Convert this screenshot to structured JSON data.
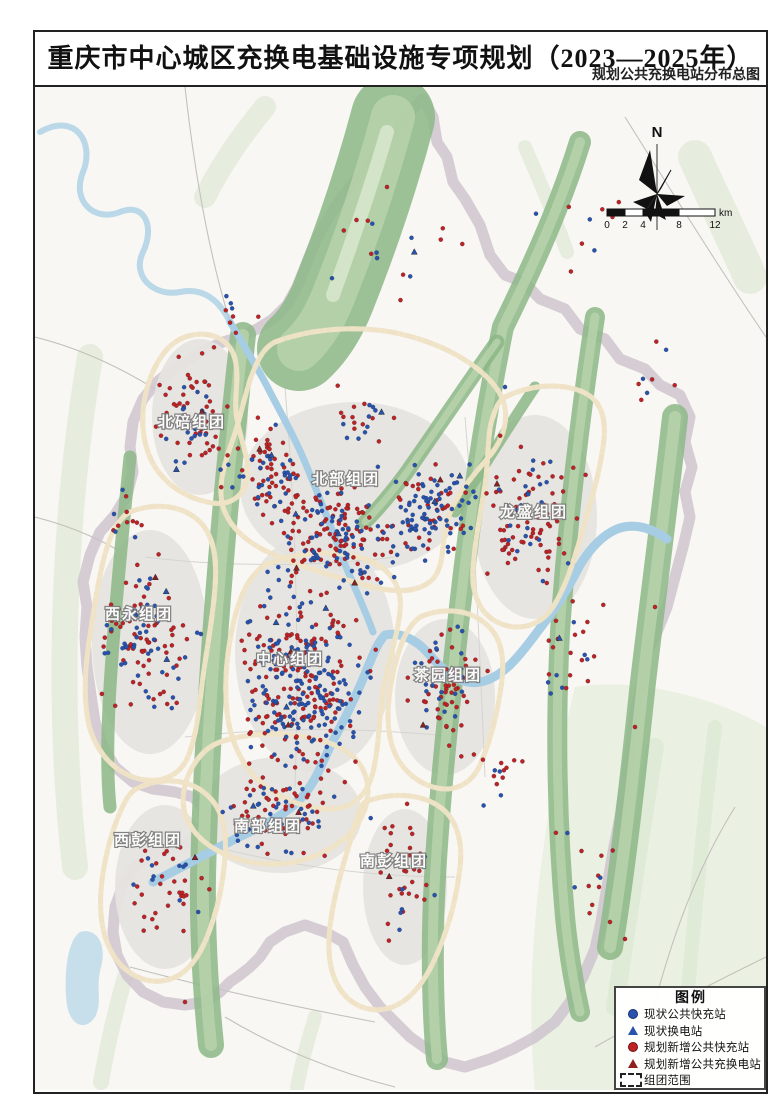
{
  "page": {
    "title": "重庆市中心城区充换电基础设施专项规划（2023—2025年）",
    "subtitle": "规划公共充换电站分布总图"
  },
  "map": {
    "north_label": "N",
    "scalebar": {
      "ticks": [
        "0",
        "2",
        "4",
        "8",
        "12"
      ],
      "unit": "km"
    },
    "legend": {
      "title": "图例",
      "items": [
        {
          "symbol": "sym-dot-blue",
          "name": "existing-fast-charge-station",
          "label": "现状公共快充站"
        },
        {
          "symbol": "sym-tri-blue",
          "name": "existing-swap-station",
          "label": "现状换电站"
        },
        {
          "symbol": "sym-dot-red",
          "name": "planned-fast-charge-station",
          "label": "规划新增公共快充站"
        },
        {
          "symbol": "sym-tri-darkred",
          "name": "planned-charge-swap-station",
          "label": "规划新增公共充换电站"
        },
        {
          "symbol": "sym-dash-box",
          "name": "cluster-boundary",
          "label": "组团范围"
        }
      ]
    },
    "districts": [
      {
        "name": "北碚组团",
        "x": 157,
        "y": 340
      },
      {
        "name": "北部组团",
        "x": 311,
        "y": 397
      },
      {
        "name": "龙盛组团",
        "x": 499,
        "y": 430
      },
      {
        "name": "西永组团",
        "x": 104,
        "y": 532
      },
      {
        "name": "中心组团",
        "x": 255,
        "y": 577
      },
      {
        "name": "茶园组团",
        "x": 413,
        "y": 593
      },
      {
        "name": "西彭组团",
        "x": 113,
        "y": 758
      },
      {
        "name": "南部组团",
        "x": 233,
        "y": 744
      },
      {
        "name": "南彭组团",
        "x": 359,
        "y": 779
      }
    ],
    "colors": {
      "red": "#bf2222",
      "blue": "#2753ae",
      "tri_red": "#8e2020",
      "boundary": "#a293a2",
      "ridge": "#8cb786",
      "river": "#a6cde4"
    },
    "station_clusters": [
      {
        "cx": 270,
        "cy": 590,
        "rx": 82,
        "ry": 115,
        "red": 150,
        "blue": 165,
        "tri_red": 3,
        "tri_blue": 3
      },
      {
        "cx": 300,
        "cy": 445,
        "rx": 95,
        "ry": 75,
        "red": 115,
        "blue": 75,
        "tri_red": 2,
        "tri_blue": 2
      },
      {
        "cx": 395,
        "cy": 420,
        "rx": 60,
        "ry": 65,
        "red": 35,
        "blue": 75,
        "tri_red": 1,
        "tri_blue": 2
      },
      {
        "cx": 235,
        "cy": 385,
        "rx": 55,
        "ry": 60,
        "red": 50,
        "blue": 28,
        "tri_red": 1,
        "tri_blue": 1
      },
      {
        "cx": 160,
        "cy": 330,
        "rx": 48,
        "ry": 75,
        "red": 48,
        "blue": 20,
        "tri_red": 1,
        "tri_blue": 1
      },
      {
        "cx": 110,
        "cy": 555,
        "rx": 62,
        "ry": 115,
        "red": 65,
        "blue": 48,
        "tri_red": 1,
        "tri_blue": 2
      },
      {
        "cx": 495,
        "cy": 420,
        "rx": 62,
        "ry": 95,
        "red": 80,
        "blue": 22,
        "tri_red": 1,
        "tri_blue": 1
      },
      {
        "cx": 412,
        "cy": 600,
        "rx": 52,
        "ry": 80,
        "red": 55,
        "blue": 22,
        "tri_red": 1,
        "tri_blue": 1
      },
      {
        "cx": 245,
        "cy": 720,
        "rx": 80,
        "ry": 62,
        "red": 60,
        "blue": 32,
        "tri_red": 1,
        "tri_blue": 1
      },
      {
        "cx": 370,
        "cy": 790,
        "rx": 48,
        "ry": 85,
        "red": 32,
        "blue": 8,
        "tri_red": 1,
        "tri_blue": 0
      },
      {
        "cx": 132,
        "cy": 795,
        "rx": 52,
        "ry": 85,
        "red": 32,
        "blue": 10,
        "tri_red": 1,
        "tri_blue": 0
      },
      {
        "cx": 540,
        "cy": 560,
        "rx": 42,
        "ry": 65,
        "red": 16,
        "blue": 7,
        "tri_red": 0,
        "tri_blue": 1
      },
      {
        "cx": 360,
        "cy": 150,
        "rx": 110,
        "ry": 85,
        "red": 9,
        "blue": 6,
        "tri_red": 0,
        "tri_blue": 1
      },
      {
        "cx": 560,
        "cy": 140,
        "rx": 80,
        "ry": 60,
        "red": 7,
        "blue": 4,
        "tri_red": 0,
        "tri_blue": 0
      },
      {
        "cx": 545,
        "cy": 775,
        "rx": 55,
        "ry": 75,
        "red": 9,
        "blue": 3,
        "tri_red": 0,
        "tri_blue": 0
      },
      {
        "cx": 610,
        "cy": 300,
        "rx": 40,
        "ry": 60,
        "red": 5,
        "blue": 3,
        "tri_red": 0,
        "tri_blue": 0
      },
      {
        "cx": 200,
        "cy": 230,
        "rx": 40,
        "ry": 40,
        "red": 6,
        "blue": 3,
        "tri_red": 0,
        "tri_blue": 0
      },
      {
        "cx": 460,
        "cy": 690,
        "rx": 35,
        "ry": 45,
        "red": 10,
        "blue": 4,
        "tri_red": 0,
        "tri_blue": 0
      },
      {
        "cx": 320,
        "cy": 330,
        "rx": 50,
        "ry": 40,
        "red": 12,
        "blue": 8,
        "tri_red": 0,
        "tri_blue": 1
      },
      {
        "cx": 90,
        "cy": 430,
        "rx": 35,
        "ry": 45,
        "red": 8,
        "blue": 4,
        "tri_red": 0,
        "tri_blue": 0
      }
    ],
    "station_singles": [
      {
        "x": 575,
        "y": 835,
        "t": "red"
      },
      {
        "x": 590,
        "y": 852,
        "t": "red"
      },
      {
        "x": 470,
        "y": 300,
        "t": "blue"
      },
      {
        "x": 352,
        "y": 100,
        "t": "red"
      },
      {
        "x": 338,
        "y": 320,
        "t": "blue"
      },
      {
        "x": 620,
        "y": 520,
        "t": "red"
      },
      {
        "x": 600,
        "y": 640,
        "t": "red"
      },
      {
        "x": 150,
        "y": 915,
        "t": "red"
      }
    ]
  }
}
